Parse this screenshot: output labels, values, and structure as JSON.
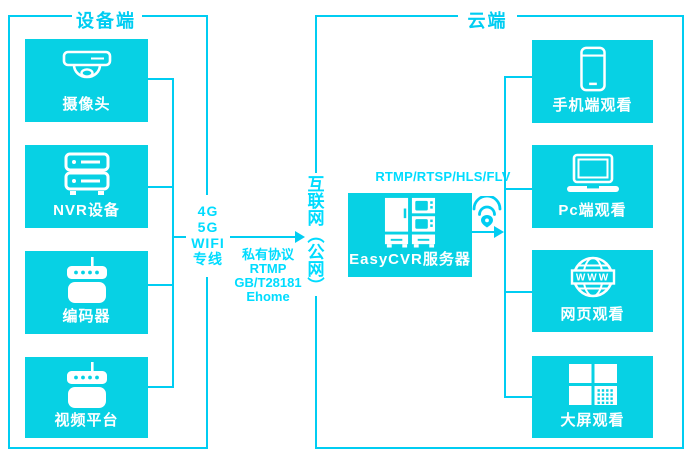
{
  "colors": {
    "box_fill": "#07d1e4",
    "line": "#00cdf2",
    "bright_text": "#00dcff",
    "box_label": "#ffffff"
  },
  "device_section": {
    "title": "设备端",
    "nodes": [
      {
        "label": "摄像头",
        "icon": "dome-camera-icon"
      },
      {
        "label": "NVR设备",
        "icon": "nvr-icon"
      },
      {
        "label": "编码器",
        "icon": "encoder-icon"
      },
      {
        "label": "视频平台",
        "icon": "video-platform-icon"
      }
    ]
  },
  "link": {
    "access_lines": [
      "4G",
      "5G",
      "WIFI",
      "专线"
    ],
    "protocols": [
      "私有协议",
      "RTMP",
      "GB/T28181",
      "Ehome"
    ],
    "internet": "互联网（公网）",
    "internet_vertical": [
      "互",
      "联",
      "网",
      "︵",
      "公",
      "网",
      "︶"
    ]
  },
  "cloud_section": {
    "title": "云端",
    "stream_protocols": "RTMP/RTSP/HLS/FLV",
    "server_label": "EasyCVR服务器",
    "globe_banner": "WWW",
    "nodes": [
      {
        "label": "手机端观看",
        "icon": "smartphone-icon"
      },
      {
        "label": "Pc端观看",
        "icon": "laptop-icon"
      },
      {
        "label": "网页观看",
        "icon": "globe-www-icon"
      },
      {
        "label": "大屏观看",
        "icon": "grid-wall-icon"
      }
    ]
  }
}
